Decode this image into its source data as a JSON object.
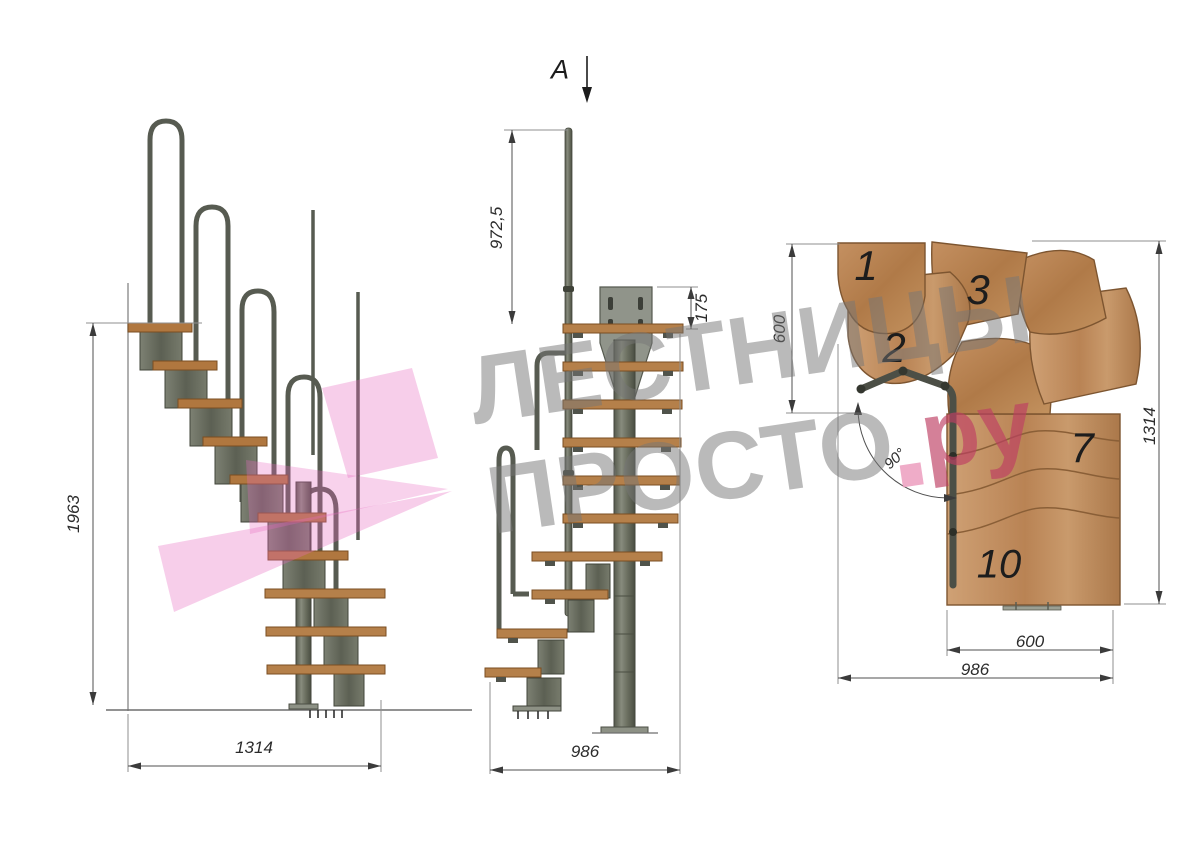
{
  "watermark": {
    "line1": "ЛЕСТНИЦЫ",
    "line2": "ПРОСТО",
    "dot": ".",
    "suffix": "ру",
    "gray_color": "#bdbdbd",
    "pink_color": "#c43e63",
    "logo_pink": "#e86bc0"
  },
  "side_view": {
    "height_mm": "1963",
    "width_mm": "1314"
  },
  "front_view": {
    "section_label": "A",
    "handrail_height_mm": "972,5",
    "plate_height_mm": "175",
    "width_mm": "986"
  },
  "plan_view": {
    "run_top_mm": "600",
    "depth_mm": "1314",
    "run_bottom_mm": "600",
    "width_mm": "986",
    "turn_angle": "90°",
    "step_numbers": {
      "first": "1",
      "second": "2",
      "third": "3",
      "seventh": "7",
      "tenth": "10"
    }
  },
  "materials": {
    "wood": "#c receive",
    "tread": "#b0773f",
    "metal": "#6e7264"
  }
}
